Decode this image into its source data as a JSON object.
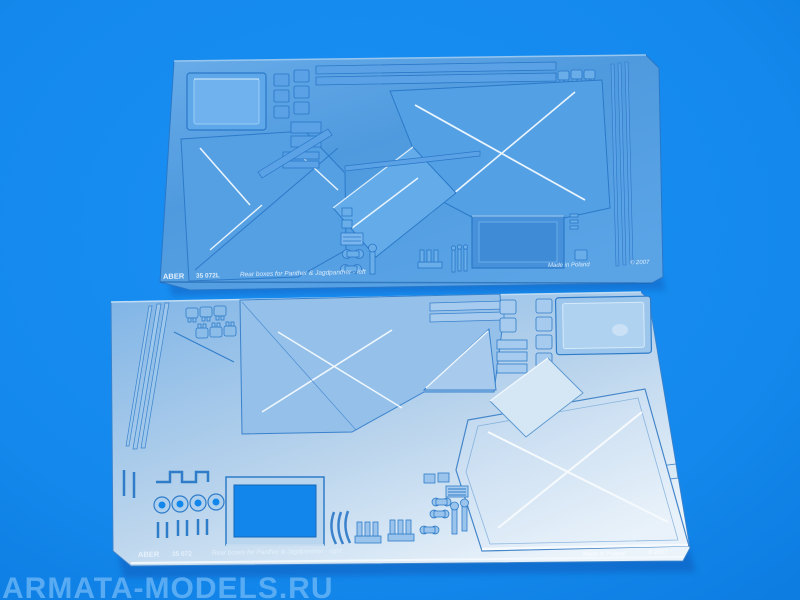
{
  "photo": {
    "description": "Product photograph of two photo-etched brass detail frets on a bright blue background",
    "background_color": "#1589ec",
    "watermark": "ARMATA-MODELS.RU",
    "watermark_color": "#6ab6f6"
  },
  "sheets": [
    {
      "position": "top",
      "brand": "ABER",
      "part_number": "35 072L",
      "caption": "Rear boxes for Panther & Jagdpanther - left",
      "made_in": "Made in Poland",
      "copyright": "© 2007",
      "color": "#4f9ade"
    },
    {
      "position": "bottom",
      "brand": "ABER",
      "part_number": "35 072",
      "caption": "Rear boxes for Panther & Jagdpanther - right",
      "made_in": "Made in Poland",
      "copyright": "© 2007",
      "color": "#b9d4ec"
    }
  ]
}
